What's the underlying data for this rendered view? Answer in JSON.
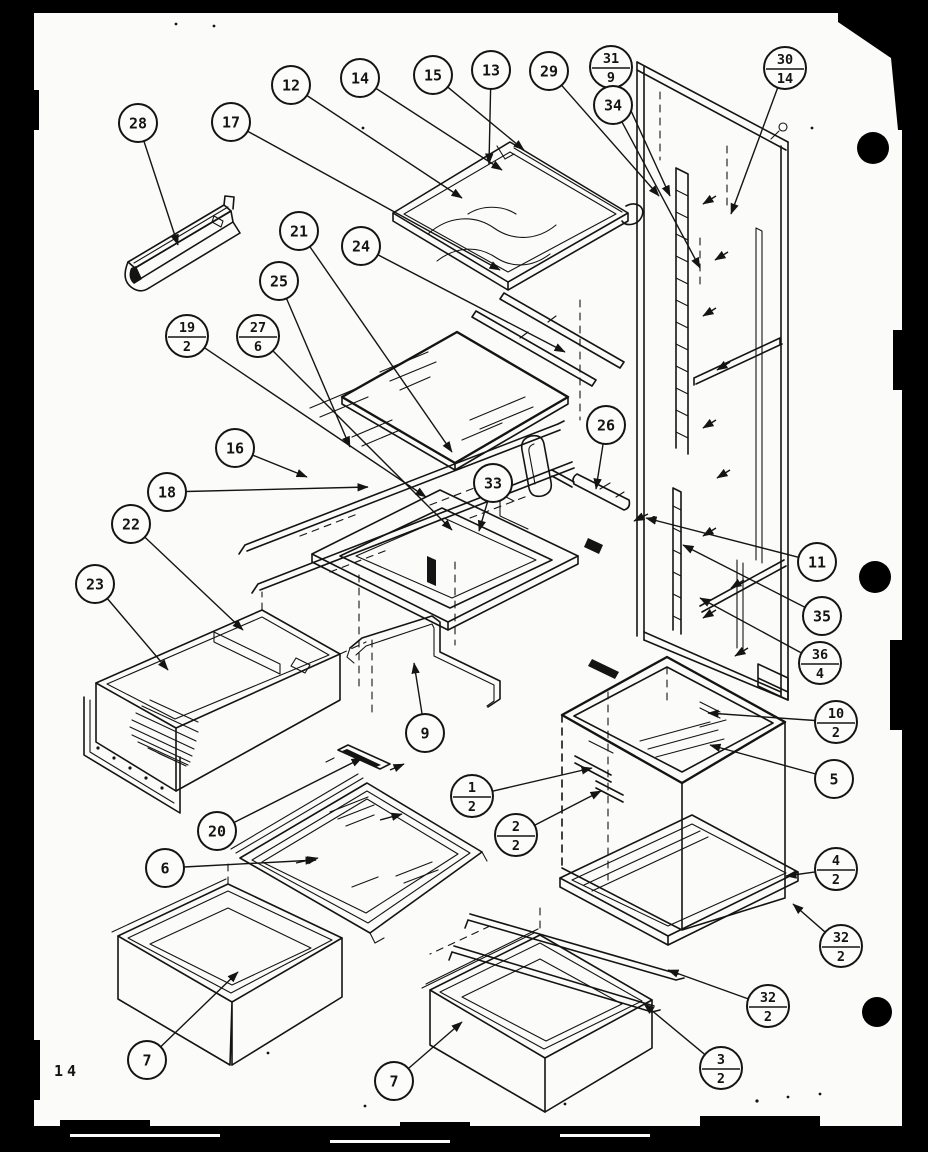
{
  "page": {
    "number": "14"
  },
  "colors": {
    "paper": "#fbfbf9",
    "ink": "#141414",
    "border": "#000000"
  },
  "diagram": {
    "name": "refrigerator-shelving-exploded-diagram",
    "callouts": [
      {
        "id": "28",
        "label": "28",
        "x": 138,
        "y": 123,
        "tx": 178,
        "ty": 245
      },
      {
        "id": "17",
        "label": "17",
        "x": 231,
        "y": 122,
        "tx": 500,
        "ty": 270
      },
      {
        "id": "12",
        "label": "12",
        "x": 291,
        "y": 85,
        "tx": 462,
        "ty": 198
      },
      {
        "id": "14",
        "label": "14",
        "x": 360,
        "y": 78,
        "tx": 502,
        "ty": 170
      },
      {
        "id": "15",
        "label": "15",
        "x": 433,
        "y": 75,
        "tx": 524,
        "ty": 150
      },
      {
        "id": "13",
        "label": "13",
        "x": 491,
        "y": 70,
        "tx": 489,
        "ty": 164
      },
      {
        "id": "29",
        "label": "29",
        "x": 549,
        "y": 71,
        "tx": 659,
        "ty": 196
      },
      {
        "id": "31-9",
        "label": "31/9",
        "x": 611,
        "y": 67,
        "tx": 670,
        "ty": 196
      },
      {
        "id": "34",
        "label": "34",
        "x": 613,
        "y": 105,
        "tx": 700,
        "ty": 268
      },
      {
        "id": "30-14",
        "label": "30/14",
        "x": 785,
        "y": 68,
        "tx": 731,
        "ty": 214
      },
      {
        "id": "21",
        "label": "21",
        "x": 299,
        "y": 231,
        "tx": 452,
        "ty": 452
      },
      {
        "id": "24",
        "label": "24",
        "x": 361,
        "y": 246,
        "tx": 565,
        "ty": 352
      },
      {
        "id": "25",
        "label": "25",
        "x": 279,
        "y": 281,
        "tx": 350,
        "ty": 447
      },
      {
        "id": "19-2",
        "label": "19/2",
        "x": 187,
        "y": 336,
        "tx": 426,
        "ty": 497
      },
      {
        "id": "27-6",
        "label": "27/6",
        "x": 258,
        "y": 336,
        "tx": 452,
        "ty": 530
      },
      {
        "id": "16",
        "label": "16",
        "x": 235,
        "y": 448,
        "tx": 307,
        "ty": 477
      },
      {
        "id": "18",
        "label": "18",
        "x": 167,
        "y": 492,
        "tx": 368,
        "ty": 487
      },
      {
        "id": "22",
        "label": "22",
        "x": 131,
        "y": 524,
        "tx": 243,
        "ty": 630
      },
      {
        "id": "23",
        "label": "23",
        "x": 95,
        "y": 584,
        "tx": 168,
        "ty": 670
      },
      {
        "id": "26",
        "label": "26",
        "x": 606,
        "y": 425,
        "tx": 596,
        "ty": 489
      },
      {
        "id": "33",
        "label": "33",
        "x": 493,
        "y": 483,
        "tx": 479,
        "ty": 531
      },
      {
        "id": "11",
        "label": "11",
        "x": 817,
        "y": 562,
        "tx": 646,
        "ty": 518
      },
      {
        "id": "35",
        "label": "35",
        "x": 822,
        "y": 616,
        "tx": 683,
        "ty": 545
      },
      {
        "id": "36-4",
        "label": "36/4",
        "x": 820,
        "y": 663,
        "tx": 700,
        "ty": 598
      },
      {
        "id": "10-2",
        "label": "10/2",
        "x": 836,
        "y": 722,
        "tx": 708,
        "ty": 713
      },
      {
        "id": "5",
        "label": "5",
        "x": 834,
        "y": 779,
        "tx": 710,
        "ty": 745
      },
      {
        "id": "1-2",
        "label": "1/2",
        "x": 472,
        "y": 796,
        "tx": 592,
        "ty": 768
      },
      {
        "id": "2-2",
        "label": "2/2",
        "x": 516,
        "y": 835,
        "tx": 601,
        "ty": 791
      },
      {
        "id": "4-2",
        "label": "4/2",
        "x": 836,
        "y": 869,
        "tx": 786,
        "ty": 876
      },
      {
        "id": "32-2a",
        "label": "32/2",
        "x": 841,
        "y": 946,
        "tx": 793,
        "ty": 904
      },
      {
        "id": "32-2b",
        "label": "32/2",
        "x": 768,
        "y": 1006,
        "tx": 668,
        "ty": 970
      },
      {
        "id": "3-2",
        "label": "3/2",
        "x": 721,
        "y": 1068,
        "tx": 644,
        "ty": 1004
      },
      {
        "id": "9",
        "label": "9",
        "x": 425,
        "y": 733,
        "tx": 414,
        "ty": 663
      },
      {
        "id": "20",
        "label": "20",
        "x": 217,
        "y": 831,
        "tx": 362,
        "ty": 758
      },
      {
        "id": "6",
        "label": "6",
        "x": 165,
        "y": 868,
        "tx": 316,
        "ty": 860
      },
      {
        "id": "7a",
        "label": "7",
        "x": 147,
        "y": 1060,
        "tx": 238,
        "ty": 972
      },
      {
        "id": "7b",
        "label": "7",
        "x": 394,
        "y": 1081,
        "tx": 462,
        "ty": 1022
      }
    ]
  }
}
